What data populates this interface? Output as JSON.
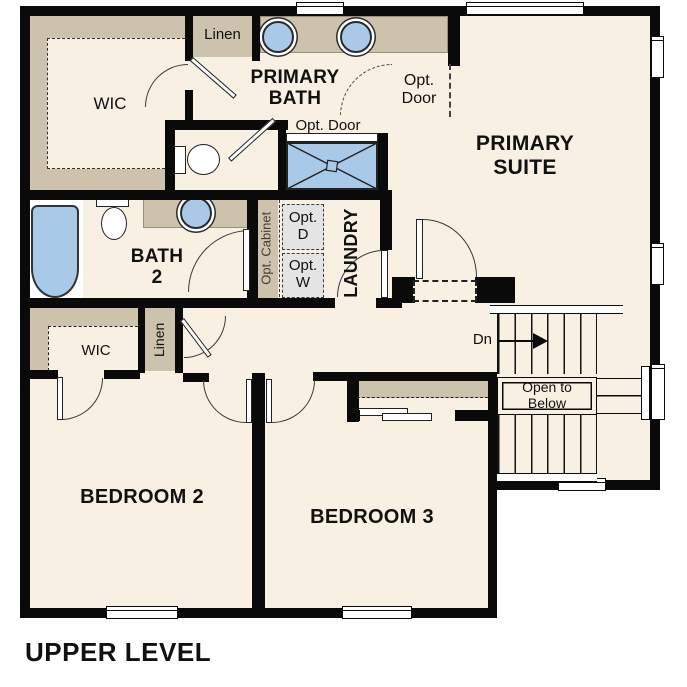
{
  "title": "UPPER LEVEL",
  "labels": {
    "primary_bath": "PRIMARY BATH",
    "primary_suite": "PRIMARY SUITE",
    "bath2": "BATH 2",
    "laundry": "LAUNDRY",
    "bedroom2": "BEDROOM 2",
    "bedroom3": "BEDROOM 3",
    "wic_primary": "WIC",
    "wic_bedroom2": "WIC",
    "linen_top": "Linen",
    "linen_hall": "Linen",
    "opt_door_suite": "Opt. Door",
    "opt_door_shower": "Opt. Door",
    "opt_cabinet": "Opt. Cabinet",
    "opt_dryer": "Opt. D",
    "opt_washer": "Opt. W",
    "stairs_down": "Dn",
    "open_to_below": "Open to Below"
  },
  "colors": {
    "floor": "#f8f0e3",
    "cabinet": "#cdc2ab",
    "fixture_blue": "#a9c9e9",
    "wall": "#0a0a0a",
    "opt_box": "#e4e4e4"
  }
}
